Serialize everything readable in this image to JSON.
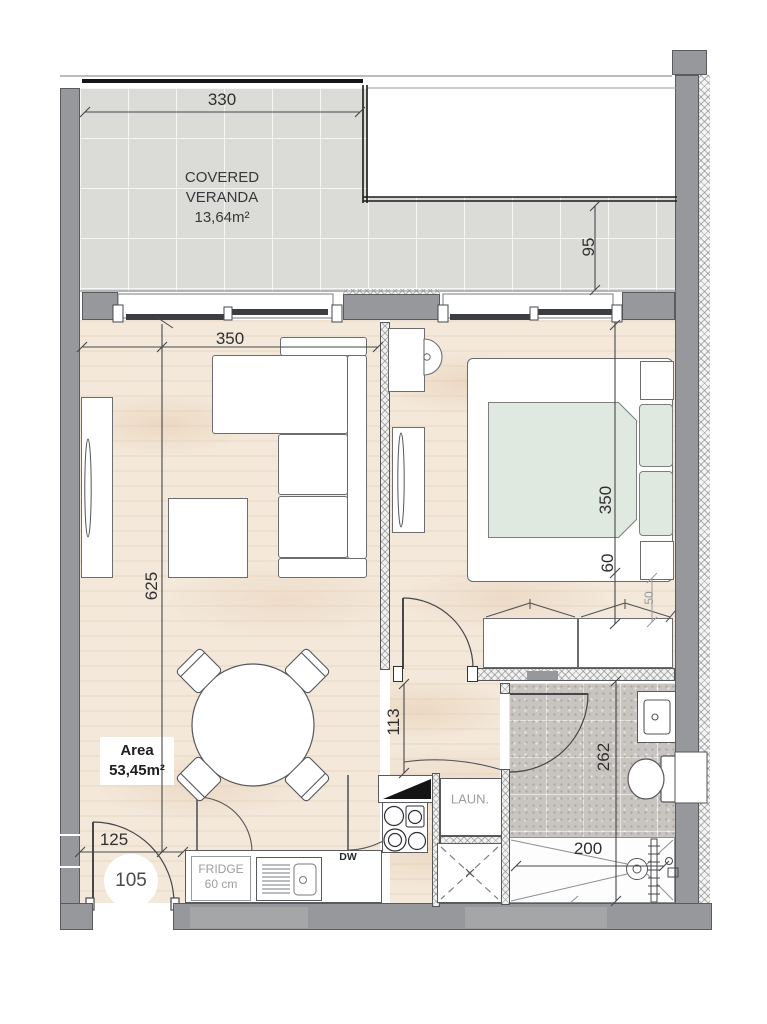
{
  "veranda": {
    "name_line1": "COVERED",
    "name_line2": "VERANDA",
    "area": "13,64m²"
  },
  "unit": {
    "number": "105",
    "area_label": "Area",
    "area_value": "53,45m²"
  },
  "dimensions": {
    "veranda_width": "330",
    "veranda_depth": "95",
    "living_width": "350",
    "living_length": "625",
    "bedroom_length": "350",
    "bed_clearance": "60",
    "wardrobe_clearance": "50",
    "hallway_width": "113",
    "bathroom_length": "262",
    "shower_length": "200",
    "entry_width": "125"
  },
  "kitchen": {
    "fridge_label": "FRIDGE",
    "fridge_size": "60 cm",
    "dishwasher_label": "DW",
    "laundry_label": "LAUN."
  },
  "colors": {
    "wall": "#97989b",
    "wood": "#f3e8da",
    "veranda_tile": "#dbdbd8",
    "bath_tile": "#c8c4c0",
    "mattress": "#e0e9e0",
    "line": "#46474b",
    "dim_text": "#2f2f31",
    "muted_text": "#9d9da0"
  }
}
